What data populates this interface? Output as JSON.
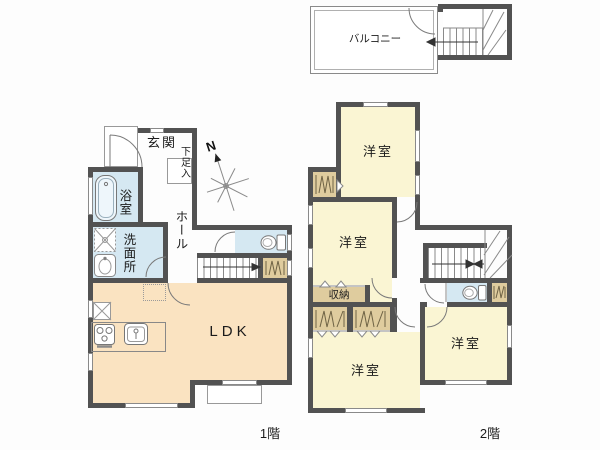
{
  "f1": {
    "floor_label": "1階",
    "entrance": "玄関",
    "shoe": "下足入",
    "bath": "浴室",
    "wash": "洗面所",
    "hall": "ホール",
    "ldk": "LDK"
  },
  "f2": {
    "floor_label": "2階",
    "balcony": "バルコニー",
    "room_a": "洋室",
    "room_b": "洋室",
    "room_c": "洋室",
    "room_d": "洋室",
    "storage": "収納"
  },
  "compass": {
    "north": "N"
  },
  "palette": {
    "wall": "#525252",
    "ldk_floor": "#fae3c1",
    "room_floor": "#faf5d3",
    "wet_floor": "#d5e8f2",
    "closet": "#dfcc9e",
    "outline": "#8a8a8a",
    "text": "#1b1b1b",
    "background": "#fdfdfd"
  }
}
